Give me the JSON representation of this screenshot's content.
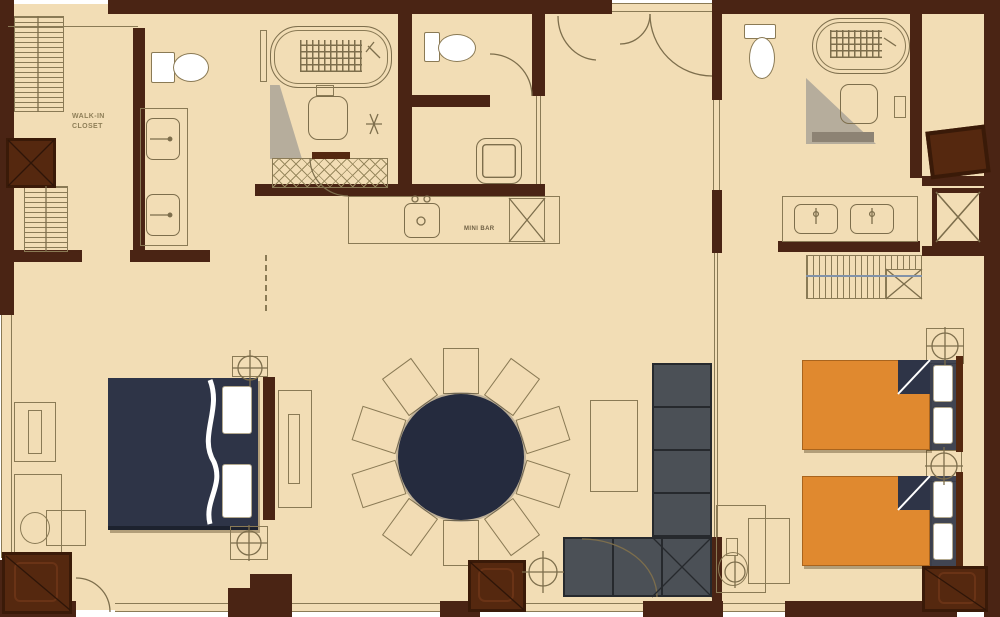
{
  "labels": {
    "walk_in_closet": "WALK-IN CLOSET",
    "mini_bar": "MINI BAR"
  },
  "dining": {
    "seats": 10,
    "table_shape": "round"
  },
  "colors": {
    "floor": "#f2ddb5",
    "wall": "#4a2414",
    "linework": "#8a7a55",
    "master_bed": "#2e3447",
    "dining_table": "#252b3e",
    "sofa": "#4b5056",
    "twin_bed_orange": "#e0892f",
    "cabinet_wood": "#55280f",
    "pillow": "#ffffff",
    "shower_shade": "#b6ad9c",
    "closet_rod": "#8292a8"
  }
}
